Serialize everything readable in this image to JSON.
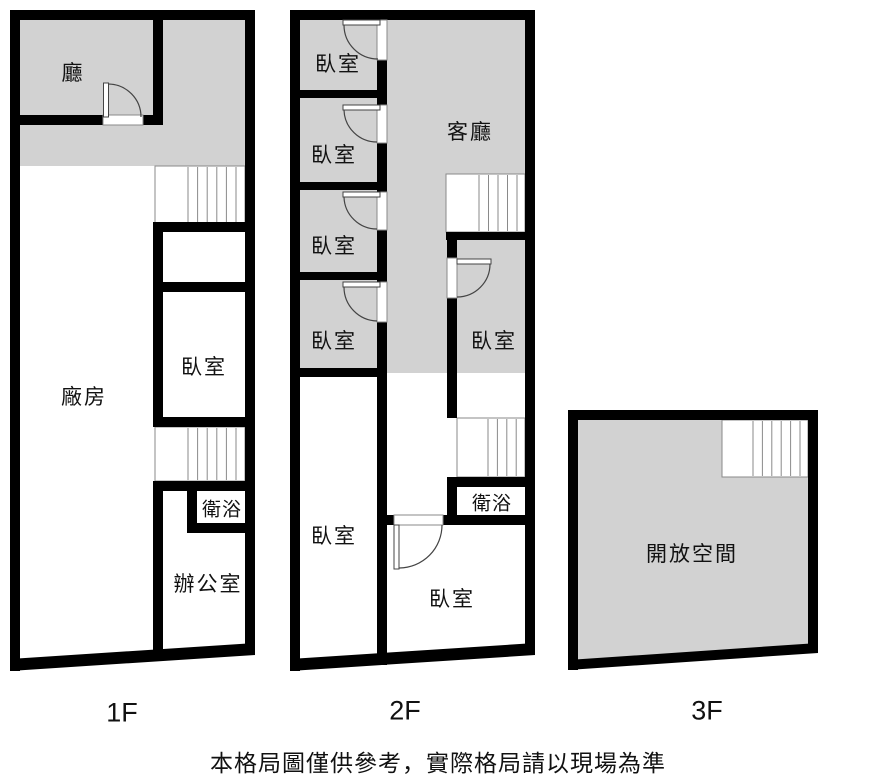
{
  "colors": {
    "wall": "#000000",
    "room_fill": "#d2d2d2",
    "line_thin": "#8a8a8a",
    "door_line": "#444444",
    "text": "#111111"
  },
  "floors": [
    {
      "name": "1f",
      "label": "1F",
      "rooms": [
        {
          "name": "hall",
          "label": "廳"
        },
        {
          "name": "factory",
          "label": "廠房"
        },
        {
          "name": "bedroom",
          "label": "臥室"
        },
        {
          "name": "bathroom",
          "label": "衛浴"
        },
        {
          "name": "office",
          "label": "辦公室"
        }
      ]
    },
    {
      "name": "2f",
      "label": "2F",
      "rooms": [
        {
          "name": "bedroom-1",
          "label": "臥室"
        },
        {
          "name": "bedroom-2",
          "label": "臥室"
        },
        {
          "name": "bedroom-3",
          "label": "臥室"
        },
        {
          "name": "living-room",
          "label": "客廳"
        },
        {
          "name": "bedroom-4",
          "label": "臥室"
        },
        {
          "name": "bedroom-5",
          "label": "臥室"
        },
        {
          "name": "bathroom",
          "label": "衛浴"
        },
        {
          "name": "bedroom-6",
          "label": "臥室"
        },
        {
          "name": "bedroom-7",
          "label": "臥室"
        }
      ]
    },
    {
      "name": "3f",
      "label": "3F",
      "rooms": [
        {
          "name": "open-space",
          "label": "開放空間"
        }
      ]
    }
  ],
  "footer": {
    "disclaimer": "本格局圖僅供參考，實際格局請以現場為準"
  }
}
